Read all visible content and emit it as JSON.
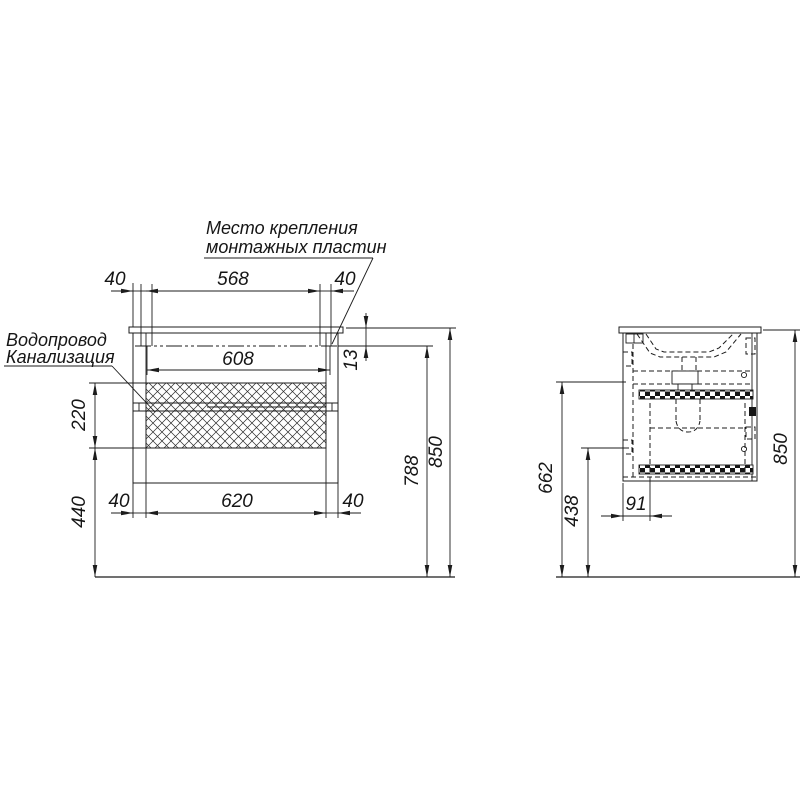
{
  "title": "Схема монтажа тумбы с раковиной",
  "labels": {
    "mounting_line1": "Место крепления",
    "mounting_line2": "монтажных пластин",
    "water": "Водопровод",
    "sewer": "Канализация"
  },
  "front": {
    "dim_top_left": "40",
    "dim_top_center": "568",
    "dim_top_right": "40",
    "dim_mount_width": "608",
    "dim_countertop": "13",
    "dim_zone_height": "220",
    "dim_zone_floor": "440",
    "dim_bottom_left": "40",
    "dim_bottom_center": "620",
    "dim_bottom_right": "40",
    "dim_mount_floor": "788",
    "dim_total": "850"
  },
  "side": {
    "dim_total": "850",
    "dim_connect": "662",
    "dim_bottom": "438",
    "dim_front": "91"
  },
  "colors": {
    "line": "#1c1c1c",
    "background": "#ffffff"
  }
}
